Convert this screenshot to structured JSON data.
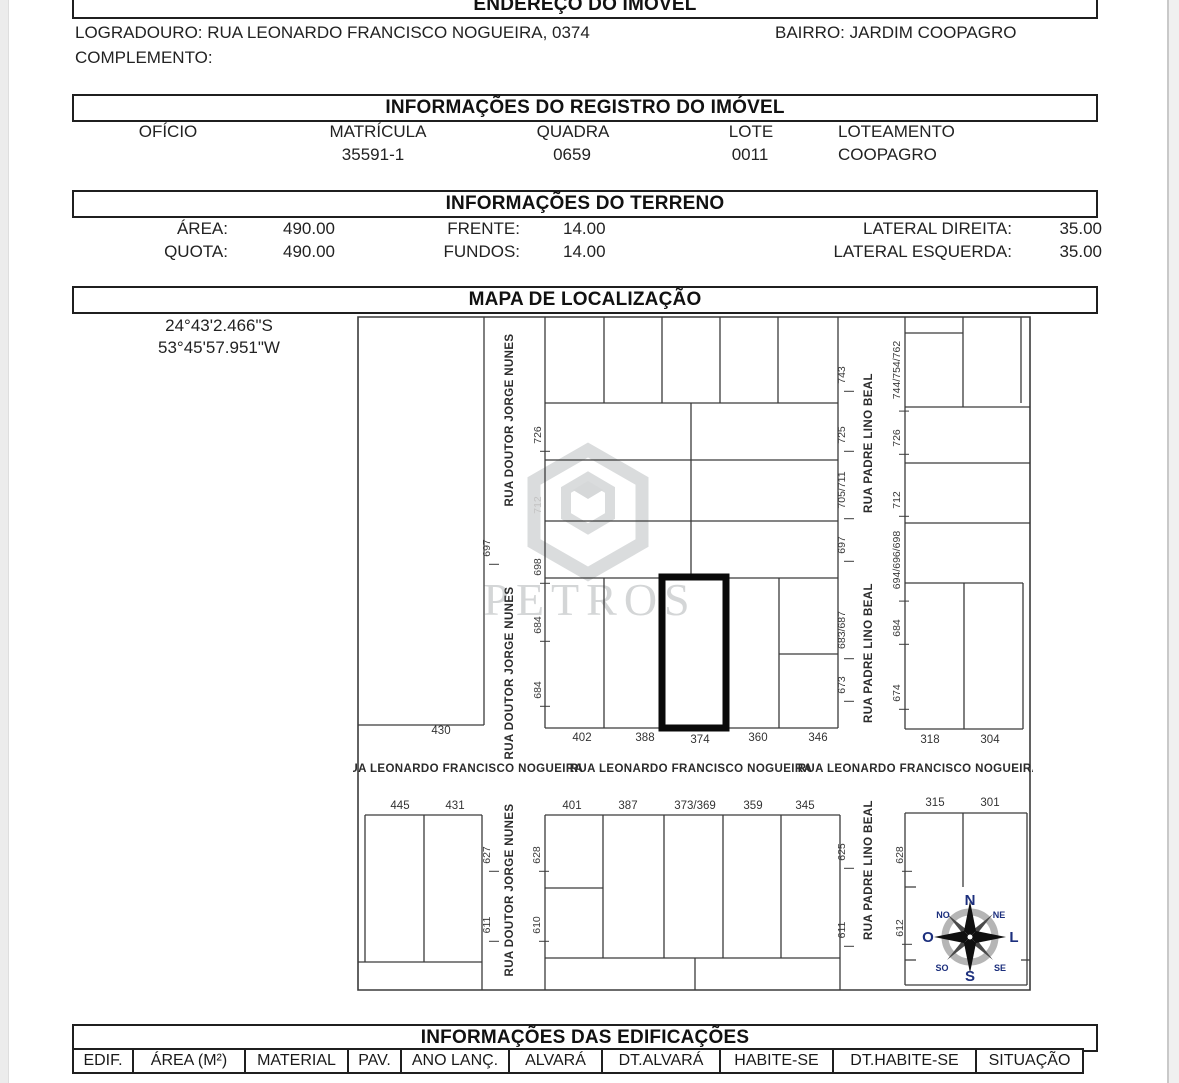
{
  "address": {
    "header": "ENDEREÇO DO IMÓVEL",
    "logradouro": "LOGRADOURO: RUA LEONARDO FRANCISCO NOGUEIRA, 0374",
    "bairro": "BAIRRO: JARDIM COOPAGRO",
    "complemento": "COMPLEMENTO:"
  },
  "registro": {
    "header": "INFORMAÇÕES DO REGISTRO DO IMÓVEL",
    "oficio_label": "OFÍCIO",
    "oficio_value": "",
    "matricula_label": "MATRÍCULA",
    "matricula_value": "35591-1",
    "quadra_label": "QUADRA",
    "quadra_value": "0659",
    "lote_label": "LOTE",
    "lote_value": "0011",
    "loteamento_label": "LOTEAMENTO",
    "loteamento_value": "COOPAGRO"
  },
  "terreno": {
    "header": "INFORMAÇÕES DO TERRENO",
    "area_label": "ÁREA:",
    "area_value": "490.00",
    "frente_label": "FRENTE:",
    "frente_value": "14.00",
    "lateral_direita_label": "LATERAL DIREITA:",
    "lateral_direita_value": "35.00",
    "quota_label": "QUOTA:",
    "quota_value": "490.00",
    "fundos_label": "FUNDOS:",
    "fundos_value": "14.00",
    "lateral_esquerda_label": "LATERAL ESQUERDA:",
    "lateral_esquerda_value": "35.00"
  },
  "mapa": {
    "header": "MAPA DE LOCALIZAÇÃO",
    "coord_lat": "24°43'2.466\"S",
    "coord_lon": "53°45'57.951\"W",
    "watermark": "PETROS",
    "highlighted_lot": "374",
    "labels_rotated": [
      {
        "t": "726",
        "x": 188,
        "y": 122
      },
      {
        "t": "712",
        "x": 188,
        "y": 192,
        "faint": true
      },
      {
        "t": "698",
        "x": 188,
        "y": 254
      },
      {
        "t": "684",
        "x": 188,
        "y": 312
      },
      {
        "t": "684",
        "x": 188,
        "y": 377
      },
      {
        "t": "697",
        "x": 137,
        "y": 235
      },
      {
        "t": "743",
        "x": 492,
        "y": 62
      },
      {
        "t": "725",
        "x": 492,
        "y": 122
      },
      {
        "t": "705/711",
        "x": 492,
        "y": 177
      },
      {
        "t": "697",
        "x": 492,
        "y": 232
      },
      {
        "t": "683/687",
        "x": 492,
        "y": 317
      },
      {
        "t": "673",
        "x": 492,
        "y": 372
      },
      {
        "t": "744/754/762",
        "x": 547,
        "y": 57
      },
      {
        "t": "726",
        "x": 547,
        "y": 125
      },
      {
        "t": "712",
        "x": 547,
        "y": 187
      },
      {
        "t": "694/696/698",
        "x": 547,
        "y": 247
      },
      {
        "t": "684",
        "x": 547,
        "y": 315
      },
      {
        "t": "674",
        "x": 547,
        "y": 380
      },
      {
        "t": "627",
        "x": 137,
        "y": 542
      },
      {
        "t": "611",
        "x": 137,
        "y": 612
      },
      {
        "t": "628",
        "x": 187,
        "y": 542
      },
      {
        "t": "610",
        "x": 187,
        "y": 612
      },
      {
        "t": "625",
        "x": 492,
        "y": 539
      },
      {
        "t": "611",
        "x": 492,
        "y": 617
      },
      {
        "t": "628",
        "x": 550,
        "y": 542
      },
      {
        "t": "612",
        "x": 550,
        "y": 615
      }
    ],
    "labels_horizontal": [
      {
        "t": "430",
        "x": 88,
        "y": 421
      },
      {
        "t": "402",
        "x": 229,
        "y": 428
      },
      {
        "t": "388",
        "x": 292,
        "y": 428
      },
      {
        "t": "374",
        "x": 347,
        "y": 430
      },
      {
        "t": "360",
        "x": 405,
        "y": 428
      },
      {
        "t": "346",
        "x": 465,
        "y": 428
      },
      {
        "t": "318",
        "x": 577,
        "y": 430
      },
      {
        "t": "304",
        "x": 637,
        "y": 430
      },
      {
        "t": "445",
        "x": 47,
        "y": 496
      },
      {
        "t": "431",
        "x": 102,
        "y": 496
      },
      {
        "t": "401",
        "x": 219,
        "y": 496
      },
      {
        "t": "387",
        "x": 275,
        "y": 496
      },
      {
        "t": "373/369",
        "x": 342,
        "y": 496
      },
      {
        "t": "359",
        "x": 400,
        "y": 496
      },
      {
        "t": "345",
        "x": 452,
        "y": 496
      },
      {
        "t": "315",
        "x": 582,
        "y": 493
      },
      {
        "t": "301",
        "x": 637,
        "y": 493
      }
    ],
    "streets_vertical": [
      {
        "t": "RUA DOUTOR JORGE NUNES",
        "x": 160,
        "y": 107
      },
      {
        "t": "RUA DOUTOR JORGE NUNES",
        "x": 160,
        "y": 360
      },
      {
        "t": "RUA DOUTOR JORGE NUNES",
        "x": 160,
        "y": 577
      },
      {
        "t": "RUA PADRE LINO BEAL",
        "x": 519,
        "y": 130
      },
      {
        "t": "RUA PADRE LINO BEAL",
        "x": 519,
        "y": 340
      },
      {
        "t": "RUA PADRE LINO BEAL",
        "x": 519,
        "y": 557
      }
    ],
    "streets_horizontal": [
      {
        "t": "RUA LEONARDO FRANCISCO NOGUEIRA",
        "x": 109,
        "y": 459
      },
      {
        "t": "RUA LEONARDO FRANCISCO NOGUEIRA",
        "x": 338,
        "y": 459
      },
      {
        "t": "RUA LEONARDO FRANCISCO NOGUEIRA",
        "x": 566,
        "y": 459
      }
    ],
    "compass": {
      "n": "N",
      "ne": "NE",
      "l": "L",
      "se": "SE",
      "s": "S",
      "so": "SO",
      "o": "O",
      "no": "NO"
    }
  },
  "edificacoes": {
    "header": "INFORMAÇÕES DAS EDIFICAÇÕES",
    "columns": [
      "EDIF.",
      "ÁREA (M²)",
      "MATERIAL",
      "PAV.",
      "ANO LANÇ.",
      "ALVARÁ",
      "DT.ALVARÁ",
      "HABITE-SE",
      "DT.HABITE-SE",
      "SITUAÇÃO"
    ]
  }
}
